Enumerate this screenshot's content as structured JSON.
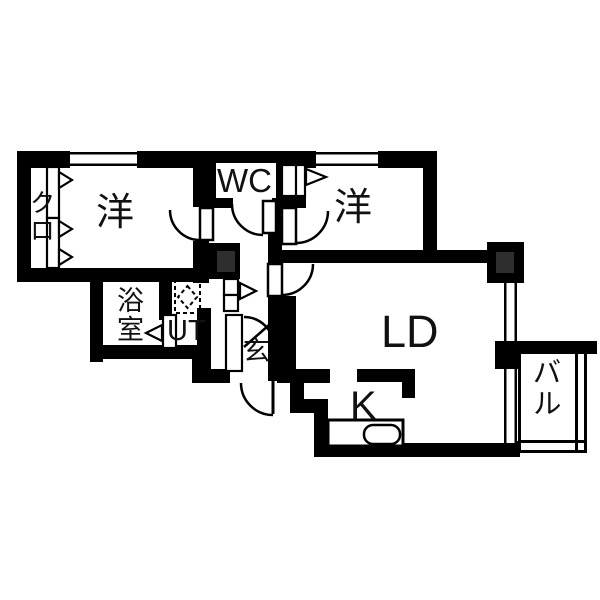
{
  "floorplan": {
    "colors": {
      "wall": "#000000",
      "background": "#ffffff",
      "pillar_inner": "#2e2e2e"
    },
    "rooms": [
      {
        "name": "closet",
        "label": "クロ"
      },
      {
        "name": "bedroom-west",
        "label": "洋"
      },
      {
        "name": "toilet",
        "label": "WC"
      },
      {
        "name": "bedroom-east",
        "label": "洋"
      },
      {
        "name": "bathroom",
        "label": "浴室"
      },
      {
        "name": "utility",
        "label": "UT"
      },
      {
        "name": "entrance",
        "label": "玄"
      },
      {
        "name": "living-dining",
        "label": "LD"
      },
      {
        "name": "kitchen",
        "label": "K"
      },
      {
        "name": "balcony",
        "label": "バル"
      }
    ],
    "fixtures": [
      {
        "name": "washing-machine-pan-icon"
      },
      {
        "name": "kitchen-sink-icon"
      },
      {
        "name": "window-icon"
      },
      {
        "name": "pillar-icon"
      },
      {
        "name": "door-swing-arc-icon"
      },
      {
        "name": "sliding-door-arrow-icon"
      }
    ]
  }
}
